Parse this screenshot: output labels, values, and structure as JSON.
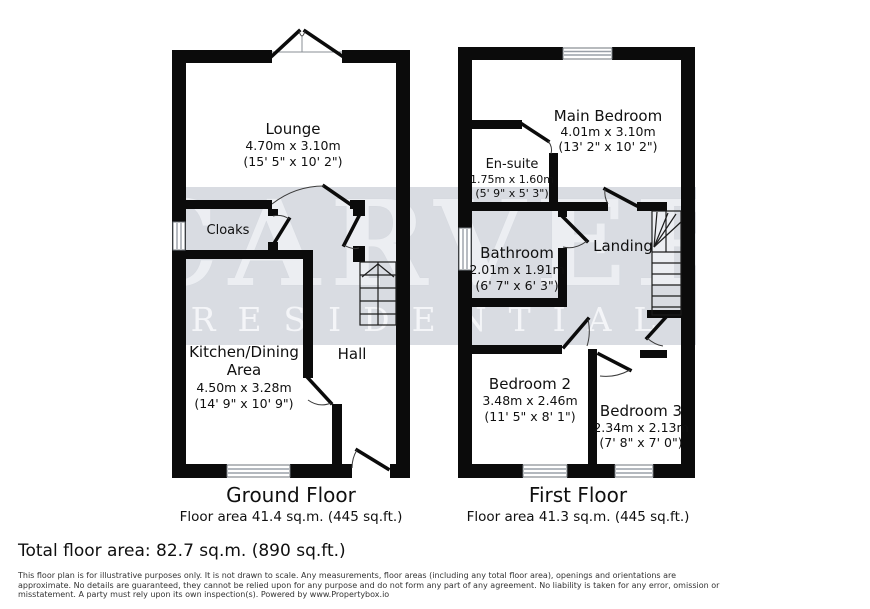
{
  "watermark": {
    "line1": "CARVER",
    "line2": "RESIDENTIAL",
    "band_color": "#d9dce2"
  },
  "ground_floor": {
    "title": "Ground Floor",
    "area": "Floor area 41.4 sq.m. (445 sq.ft.)",
    "rooms": {
      "lounge": {
        "name": "Lounge",
        "metric": "4.70m x 3.10m",
        "imperial": "(15' 5\" x 10' 2\")"
      },
      "cloaks": {
        "name": "Cloaks"
      },
      "kitchen": {
        "name_line1": "Kitchen/Dining",
        "name_line2": "Area",
        "metric": "4.50m x 3.28m",
        "imperial": "(14' 9\" x 10' 9\")"
      },
      "hall": {
        "name": "Hall"
      }
    }
  },
  "first_floor": {
    "title": "First Floor",
    "area": "Floor area 41.3 sq.m. (445 sq.ft.)",
    "rooms": {
      "main_bedroom": {
        "name": "Main Bedroom",
        "metric": "4.01m x 3.10m",
        "imperial": "(13' 2\" x 10' 2\")"
      },
      "ensuite": {
        "name": "En-suite",
        "metric": "1.75m x 1.60m",
        "imperial": "(5' 9\" x 5' 3\")"
      },
      "bathroom": {
        "name": "Bathroom",
        "metric": "2.01m x 1.91m",
        "imperial": "(6' 7\" x 6' 3\")"
      },
      "landing": {
        "name": "Landing"
      },
      "bedroom2": {
        "name": "Bedroom 2",
        "metric": "3.48m x 2.46m",
        "imperial": "(11' 5\" x 8' 1\")"
      },
      "bedroom3": {
        "name": "Bedroom 3",
        "metric": "2.34m x 2.13m",
        "imperial": "(7' 8\" x 7' 0\")"
      }
    }
  },
  "summary": {
    "total": "Total floor area: 82.7 sq.m. (890 sq.ft.)"
  },
  "disclaimer": {
    "line1": "This floor plan is for illustrative purposes only. It is not drawn to scale. Any measurements, floor areas (including any total floor area), openings and orientations are",
    "line2": "approximate. No details are guaranteed, they cannot be relied upon for any purpose and do not form any part of any agreement. No liability is taken for any error, omission or",
    "line3": "misstatement. A party must rely upon its own inspection(s). Powered by www.Propertybox.io"
  }
}
